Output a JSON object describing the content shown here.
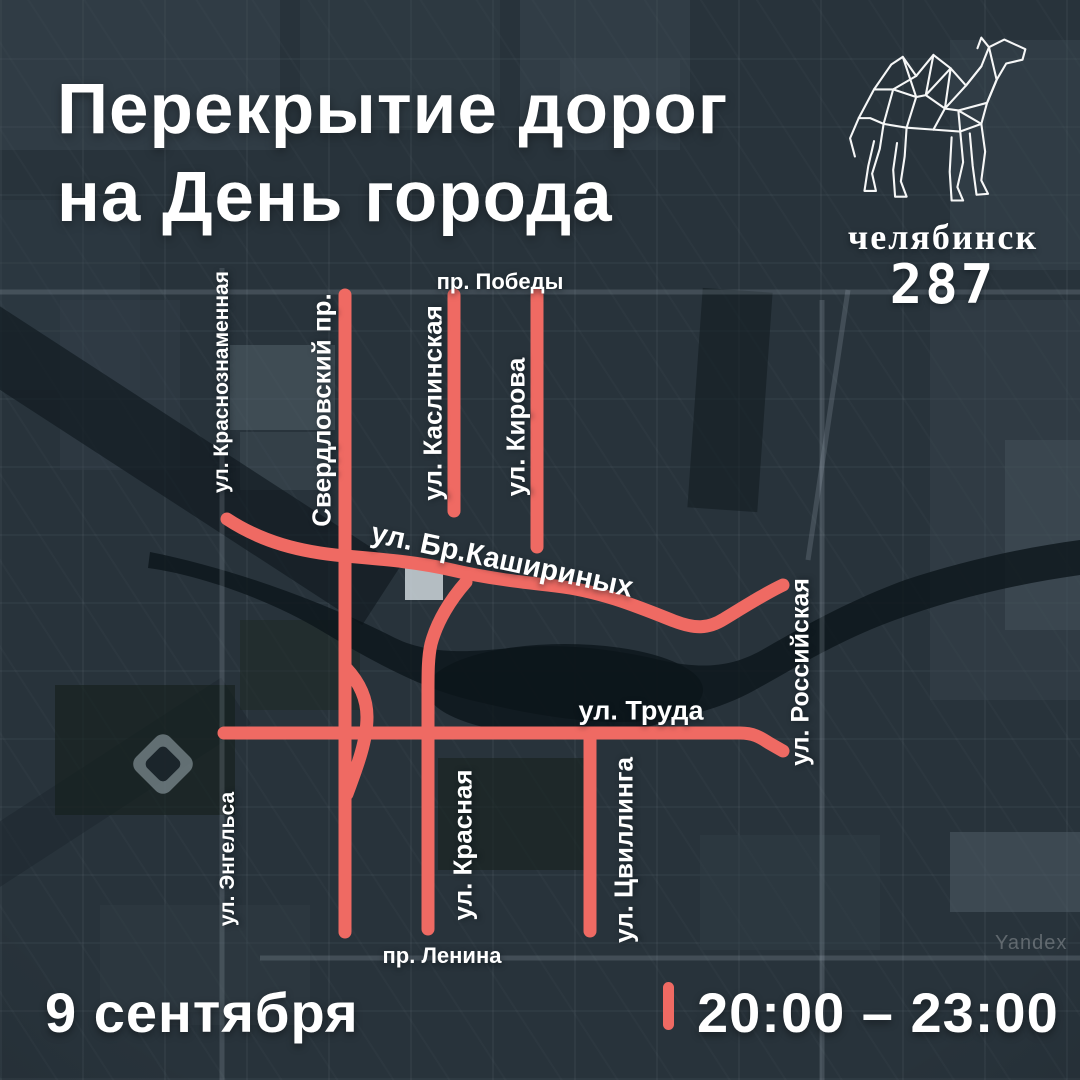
{
  "title": {
    "line1": "Перекрытие дорог",
    "line2": "на День города"
  },
  "logo": {
    "city": "челябинск",
    "anniversary": "287",
    "camel_icon": "low-poly-camel"
  },
  "map": {
    "watermark": "Yandex",
    "streets": {
      "pobedy": "пр. Победы",
      "krasnoznamennaya": "ул. Краснознаменная",
      "sverdlovsky": "Свердловский пр.",
      "kaslinskaya": "ул. Каслинская",
      "kirova": "ул. Кирова",
      "kashirinykh": "ул. Бр.Кашириных",
      "rossiyskaya": "ул. Российская",
      "truda": "ул. Труда",
      "engelsa": "ул. Энгельса",
      "krasnaya": "ул. Красная",
      "tsvillinga": "ул. Цвиллинга",
      "lenina": "пр. Ленина"
    }
  },
  "footer": {
    "date": "9 сентября",
    "time": "20:00 – 23:00"
  },
  "colors": {
    "accent_red": "#ef6a63",
    "background": "#28333b",
    "text": "#ffffff"
  }
}
